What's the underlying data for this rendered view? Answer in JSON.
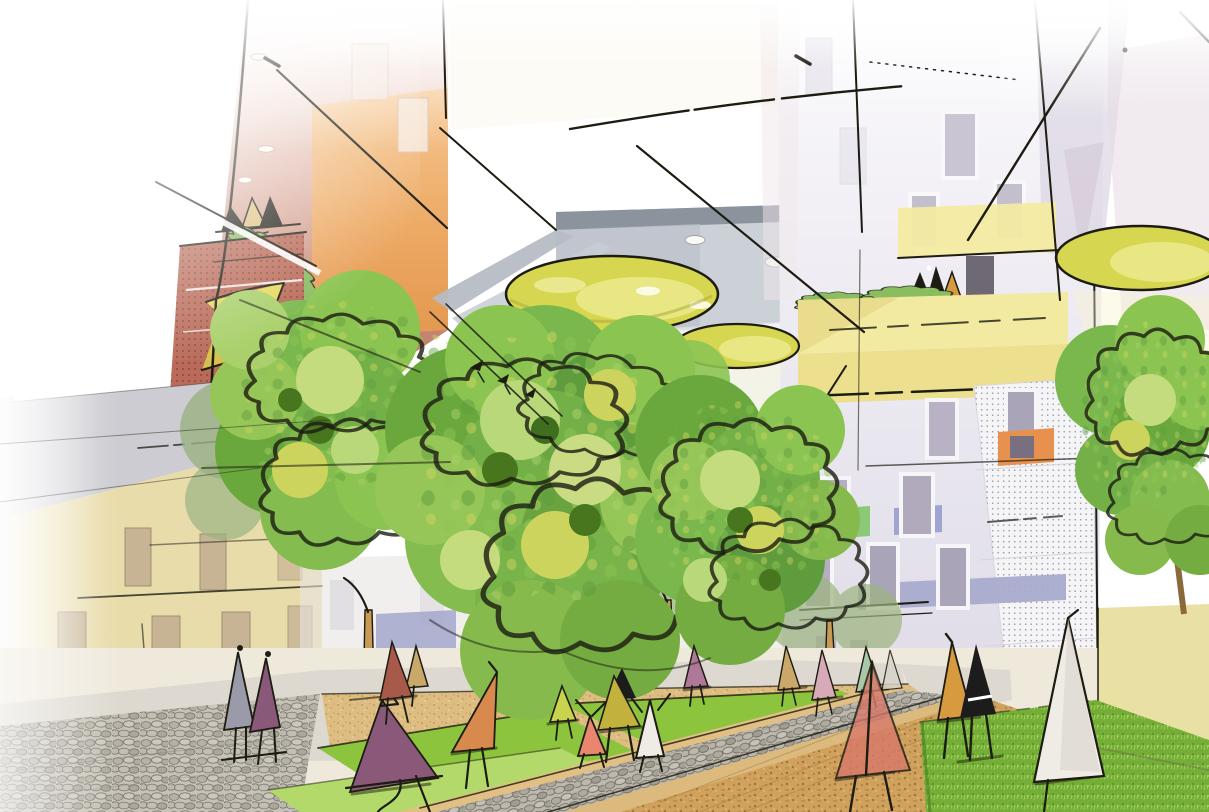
{
  "image": {
    "subject": "architectural concept sketch of a residential courtyard with trees, hanging yellow canopy discs, colored facades and abstract human figures"
  },
  "palette": {
    "white": "#ffffff",
    "facade_red": "#b5705f",
    "facade_red_perforated": "#b96a58",
    "facade_orange": "#efab62",
    "sail_yellow": "#e6d95c",
    "sail_yellow_deep": "#d8c84e",
    "disc_yellow": "#d7d650",
    "disc_yellow_light": "#ebe98a",
    "beam_yellow": "#f7f3cd",
    "soffit_gray": "#ccd1d8",
    "soffit_gray_dark": "#8b939d",
    "right_facade": "#ebe9f1",
    "balcony_yellow": "#f3eaa2",
    "balcony_yellow_deep": "#ecdf8e",
    "wall_yellow": "#e9e0a4",
    "accent_orange": "#e8914e",
    "accent_green": "#8bc878",
    "accent_periwinkle": "#9fa5d2",
    "accent_lavender": "#a9abce",
    "window_glass": "#b0aabc",
    "window_frame": "#f6f6f8",
    "window_tan": "#c6b494",
    "cream_facade": "#e9dcab",
    "cream_gray": "#cdccd2",
    "hedge_green": "#8abc60",
    "tree_green": "#7ab84e",
    "tree_green_dark": "#5f9c3e",
    "tree_green_light": "#a9d06a",
    "tree_green_pale": "#c6dc82",
    "tree_yellow_green": "#ccd45a",
    "trunk_tan": "#c79a55",
    "lawn_green": "#8cc43e",
    "lawn_green_light": "#b3d96a",
    "lawn_green_dark": "#4e7c2a",
    "sand_tan": "#ddbb80",
    "dirt_tan": "#cfa25e",
    "cobble_gray": "#c6c2b8",
    "ink": "#1c1c12",
    "person_purple": "#8a5878",
    "person_plum": "#b07898",
    "person_orange": "#d8894e",
    "person_salmon": "#e8876e",
    "person_lime": "#c9d44e",
    "person_olive": "#c3b13e",
    "person_black": "#1c1c1c",
    "person_white": "#efece6",
    "person_tan": "#c9a86a",
    "person_pink": "#d8aab8",
    "person_green": "#a8c8a8",
    "person_mustard": "#d89a3e",
    "person_red": "#d87a6a",
    "person_gray": "#9a9aa8",
    "person_maroon": "#a85a4a"
  },
  "inventory": {
    "canopy_discs": 3,
    "ceiling_downlights": 4,
    "facade_downlights": 3,
    "foreground_trees": 4,
    "background_trees": 5,
    "tree_trunks": 7,
    "people_on_ground": 20,
    "people_on_balconies": 6,
    "hedge_planters": 5,
    "lawn_patches": 4
  }
}
